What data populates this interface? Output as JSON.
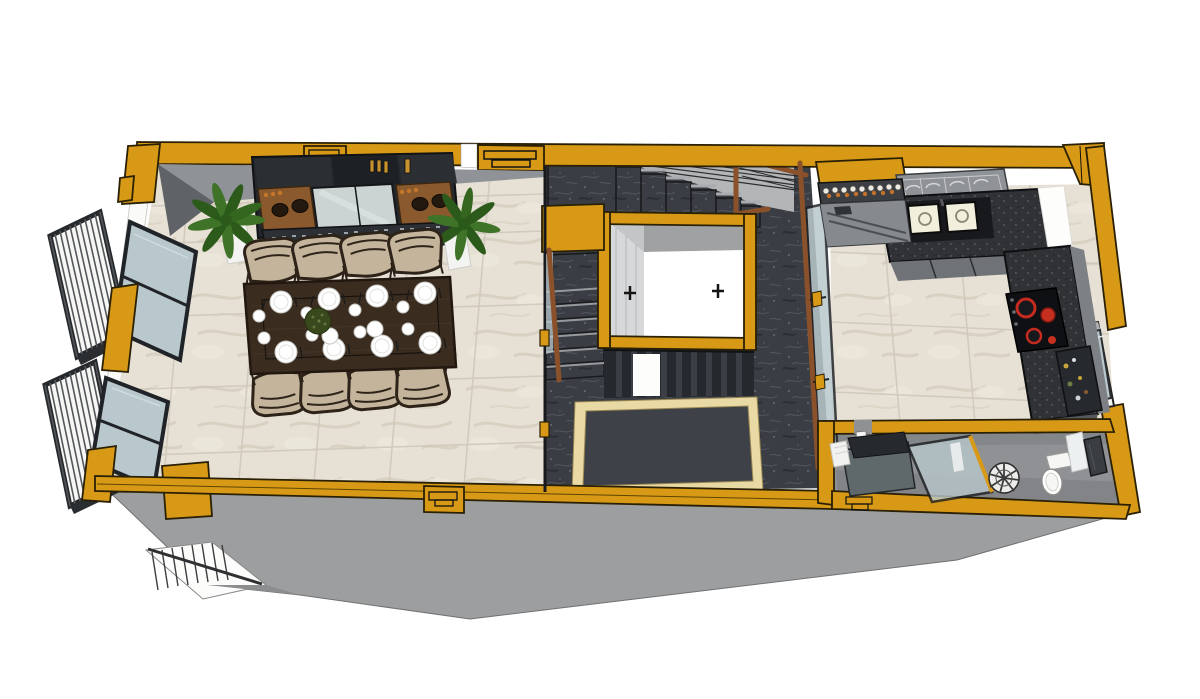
{
  "meta": {
    "type": "3d-floorplan-render",
    "view": "top-down axonometric cutaway of one apartment level",
    "description": "3D cutaway floor plan render: dining room with 8-seat dark wood table and sideboard, two left balconies, central stair hall in dark marble with stairwell void and cream-bordered inlay rug, kitchen with L-shaped speckled counter, double sink, dish rack and red-ring cooktop, bathroom with shower screen, fan basin and toilet; ochre-yellow cut walls."
  },
  "colors": {
    "wall_yellow": "#D89A16",
    "wall_yellow_deep": "#B47E0B",
    "outline_dark": "#1A1A1A",
    "floor_dark_marble": "#3A3D43",
    "floor_dark_vein": "#585C65",
    "floor_light_marble": "#E7E1D5",
    "floor_light_vein": "#D6CFBF",
    "tile_grout": "#CFC8B9",
    "wall_gray": "#8F9296",
    "wall_gray_dark": "#5F6266",
    "building_side_gray": "#9C9E9F",
    "glass_blue": "#B9C8CC",
    "frame_dark": "#202327",
    "wood_brown": "#8A512A",
    "table_wood": "#3A2D20",
    "chair_beige": "#C3B49B",
    "chair_frame": "#2E2318",
    "plant_green": "#3F7328",
    "plant_green_dark": "#2C5A1A",
    "rug_border": "#E9D9A4",
    "burner_red": "#C52B1F",
    "cooktop_black": "#0F1013",
    "sink_cream": "#F2EFDC",
    "counter_speckle_base": "#303236",
    "cabinet_dark": "#24272B",
    "bath_floor_gray": "#8F9194",
    "white": "#FFFFFF"
  },
  "rooms": {
    "dining_room": {
      "floor": "light marble tile",
      "features": [
        "dark wood dining table",
        "8 beige chairs",
        "16 white plates",
        "2 serving plates",
        "green centerpiece",
        "dark sideboard with glassware and bowls",
        "2 potted palm plants",
        "2 windows",
        "2 balconies with white railings"
      ]
    },
    "stair_hall": {
      "floor": "dark marble tile",
      "features": [
        "upper stair flight with cable railing and wood handrail",
        "stairwell void framed in yellow showing lower floor",
        "lower stair flight",
        "cream-bordered floor inlay rug",
        "glass partitions"
      ]
    },
    "kitchen": {
      "floor": "light marble tile",
      "features": [
        "L-shaped dark speckled counter",
        "double sink",
        "dish rack",
        "induction cooktop with red burners",
        "bottle shelf",
        "open shelf with items",
        "window"
      ]
    },
    "bathroom": {
      "floor": "gray screed",
      "features": [
        "bench with dark slab",
        "rolled white towel",
        "glass shower screen with yellow post",
        "round fan-pattern basin",
        "toilet",
        "white panel",
        "dark door"
      ]
    }
  }
}
